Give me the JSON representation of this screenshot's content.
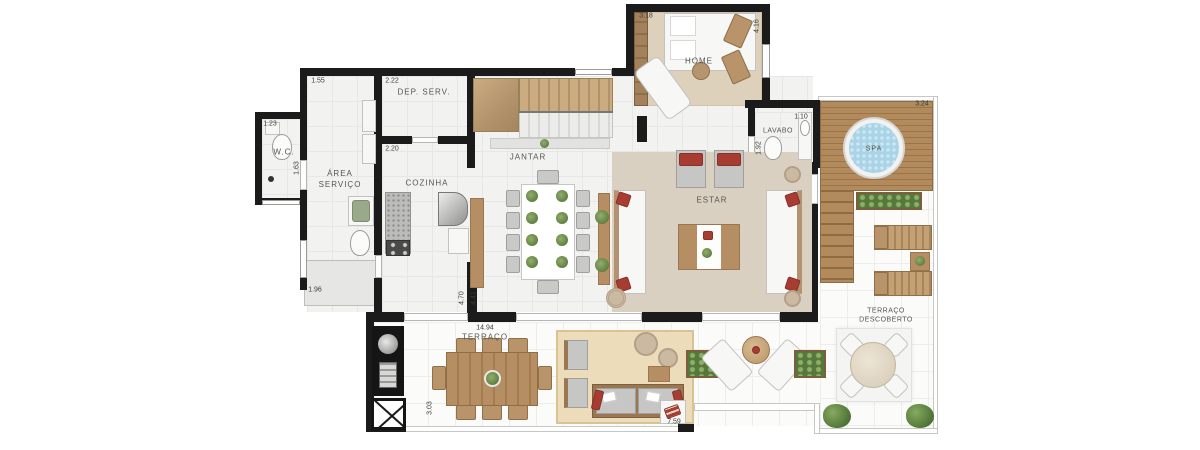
{
  "figure_type": "apartment floor plan (duplex lower level)",
  "rooms": {
    "wc": "W.C.",
    "area_servico": "ÁREA\nSERVIÇO",
    "dep_serv": "DEP. SERV.",
    "cozinha": "COZINHA",
    "jantar": "JANTAR",
    "home": "HOME",
    "lavabo": "LAVABO",
    "estar": "ESTAR",
    "spa": "SPA",
    "terraco": "TERRAÇO",
    "terraco_descoberto": "TERRAÇO\nDESCOBERTO"
  },
  "dimensions": {
    "area_servico_width": "1.55",
    "dep_serv_width": "2.22",
    "cozinha_width": "2.20",
    "wc_width": "1.23",
    "wc_depth": "1.63",
    "home_width": "3.18",
    "home_depth": "4.16",
    "lavabo_width": "1.10",
    "lavabo_depth": "1.92",
    "ledge_width": "1.96",
    "jantar_depth_a": "4.70",
    "jantar_depth_b": "4.41",
    "terraco_width": "14.94",
    "terraco_depth": "3.03",
    "lounge_width": "7.59",
    "spa_deck_width": "3.24"
  },
  "colors": {
    "wall": "#1b1b1b",
    "indoor_floor": "#f2f2f0",
    "terrace_floor": "#fbfbfa",
    "wood_deck": "#a9805a",
    "furniture_wood": "#b68e63",
    "rug": "#d9d0c1",
    "accent_red": "#a63c32",
    "spa_water": "#a9d3e6",
    "plant_green": "#5c7d3e"
  }
}
